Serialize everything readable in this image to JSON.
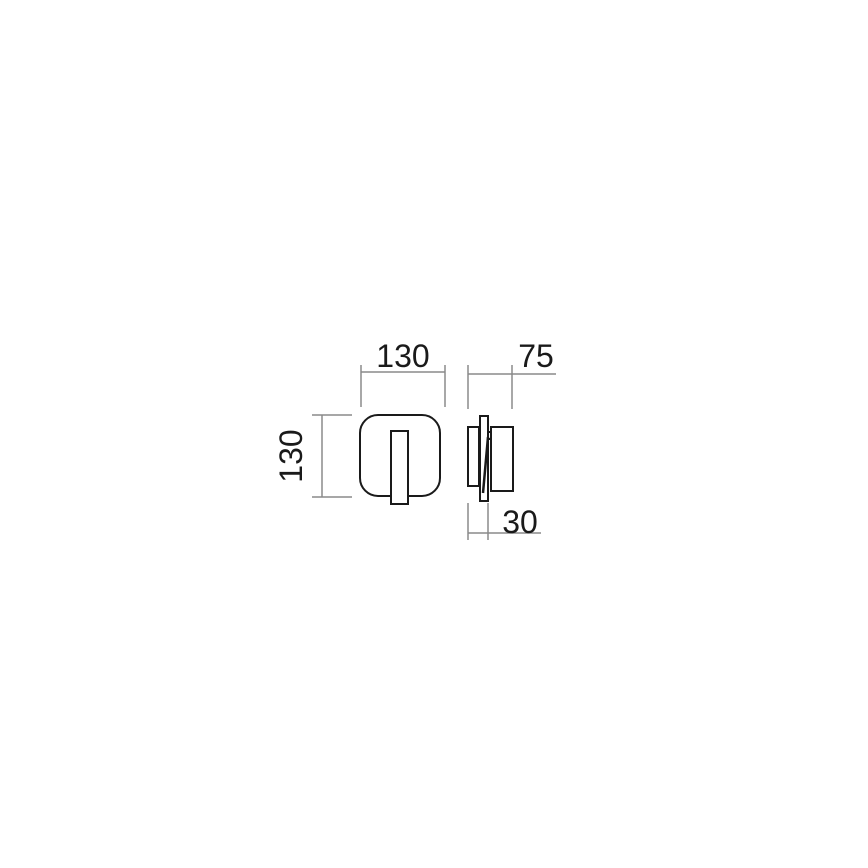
{
  "drawing": {
    "kind": "technical-dimension-drawing",
    "views": {
      "front_view": "rounded-square lamp body with vertical blade",
      "side_view": "wall plate, mounting blade, lamp head, cable"
    },
    "colors": {
      "background": "#ffffff",
      "object_outline": "#1a1a1a",
      "dimension_lines": "#8a8a8a",
      "dimension_text": "#1a1a1a"
    }
  },
  "dims": {
    "front_width": {
      "label": "130"
    },
    "front_height": {
      "label": "130"
    },
    "total_depth": {
      "label": "75"
    },
    "plate_depth": {
      "label": "30"
    }
  }
}
